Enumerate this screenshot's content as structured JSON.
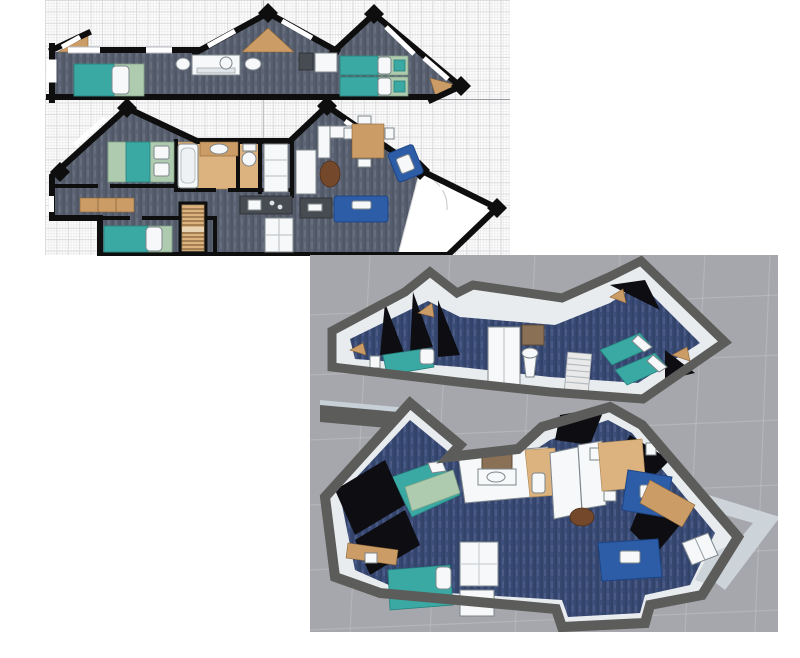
{
  "workspace": {
    "description": "floor-plan-editor-workspace",
    "panels": [
      {
        "id": "plan-2d",
        "kind": "2d-floor-plans",
        "grid": true
      },
      {
        "id": "plan-3d",
        "kind": "3d-overview-render"
      }
    ]
  },
  "plan2d": {
    "floors": [
      {
        "id": "upper-floor",
        "rooms": [
          "bedroom-left",
          "bathroom-corridor",
          "bedroom-right"
        ],
        "furniture": [
          "single-bed",
          "washbasin",
          "shower",
          "toilet",
          "washbasin",
          "appliance",
          "wardrobe",
          "twin-bed",
          "twin-bed"
        ]
      },
      {
        "id": "main-floor",
        "rooms": [
          "master-bedroom",
          "bathroom",
          "wc",
          "living-room",
          "dining-area",
          "kitchen",
          "lower-bedroom",
          "entry-hall",
          "stairs"
        ],
        "furniture": [
          "double-bed",
          "bathtub",
          "vanity-sink",
          "toilet",
          "tall-cabinet",
          "corner-sofa-white",
          "dining-table",
          "armchair",
          "coffee-table",
          "tv-bench",
          "sofa",
          "sideboard",
          "stairs",
          "single-bed",
          "kitchen-counter",
          "appliances"
        ]
      }
    ]
  },
  "view3d": {
    "floors": [
      "upper-floor-3d",
      "main-floor-3d"
    ],
    "furniture": [
      "single-bed",
      "wardrobe",
      "mirror-vanity",
      "pedestal-sink",
      "stairs",
      "twin-beds",
      "double-bed",
      "bathroom-vanity",
      "toilet",
      "kitchen-units",
      "dining-table",
      "armchair",
      "sofa",
      "coffee-table",
      "desk",
      "entry-doors"
    ]
  },
  "colors": {
    "gridMinor": "#ededee",
    "gridMajor": "#dcdcde",
    "divider": "#9c9ca0",
    "pageLine": "#c2c2c6",
    "wall2d": "#0e0e0e",
    "carpet2d": "#5c6475",
    "wood": "#cc9c66",
    "woodLight": "#dcb27e",
    "teal": "#3aa9a3",
    "tealDark": "#25807c",
    "sage": "#aecbb0",
    "sofaBlue": "#2d5da6",
    "sofaBlueDark": "#1d4587",
    "fixture": "#f6f8f9",
    "counterDark": "#474c52",
    "bg3d": "#a6a7ac",
    "wallTop3d": "#5c5c5a",
    "wallFace3d": "#e8ecee",
    "wallFaceShade": "#c7d0d6",
    "carpet3d": "#3c4e7a",
    "black3d": "#0d0d12",
    "entryFloor": "#ccd4d9",
    "mirrorBrown": "#8a7055"
  }
}
